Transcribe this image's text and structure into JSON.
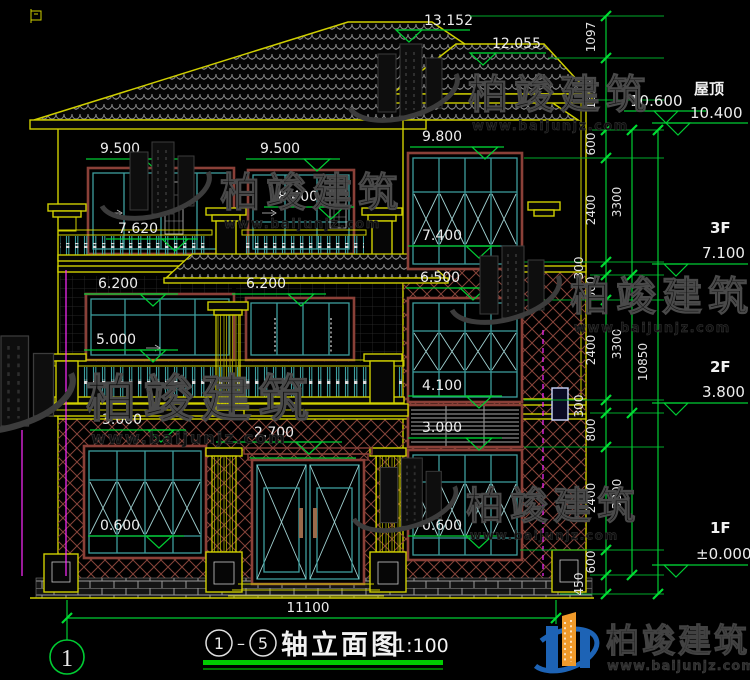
{
  "title_block": {
    "axis_start": "1",
    "axis_end": "5",
    "separator": "–",
    "title": "轴立面图",
    "scale": "1:100"
  },
  "brand": {
    "name": "柏竣建筑",
    "url": "www.baijunjz.com"
  },
  "axes": {
    "bottom_left": "1"
  },
  "dimensions": {
    "overall_width": "11100",
    "overall_height": "10850",
    "chain": [
      "1097",
      "1655",
      "600",
      "2400",
      "300",
      "600",
      "2400",
      "300",
      "800",
      "2400",
      "600",
      "450"
    ],
    "story": [
      "3300",
      "3300",
      "3800"
    ]
  },
  "levels": {
    "roof_label": "屋顶",
    "roof_elev": "10.400",
    "eave_upper": "10.600",
    "f3_label": "3F",
    "f3_elev": "7.100",
    "f2_label": "2F",
    "f2_elev": "3.800",
    "f1_label": "1F",
    "f1_elev": "±0.000"
  },
  "markers": {
    "ridge_main": "13.152",
    "ridge_wing": "12.055",
    "l3f_top": "9.500",
    "c3f_top": "9.500",
    "wing3f_top": "9.800",
    "c3f_door": "8.400",
    "rail3f": "7.620",
    "wing3f_sill": "7.400",
    "wing2f_top": "6.500",
    "l2f_top": "6.200",
    "c2f_top": "6.200",
    "l2f_sill": "5.000",
    "wing2f_sill": "4.100",
    "l1f_top": "3.000",
    "wing_louver": "3.000",
    "entry_top": "2.700",
    "l1f_sill": "0.600",
    "wing1f_sill": "0.600"
  },
  "colors": {
    "background": "#000000",
    "line_yellow": "#cfcf00",
    "line_green": "#00cc33",
    "window_teal": "#3d9e9e",
    "frame_maroon": "#8a4038",
    "dim_text": "#ededed",
    "pipe_magenta": "#ff2bff",
    "logo_blue": "#1d63b5",
    "logo_orange": "#f09a2a",
    "title_underline": "#00cc00"
  }
}
